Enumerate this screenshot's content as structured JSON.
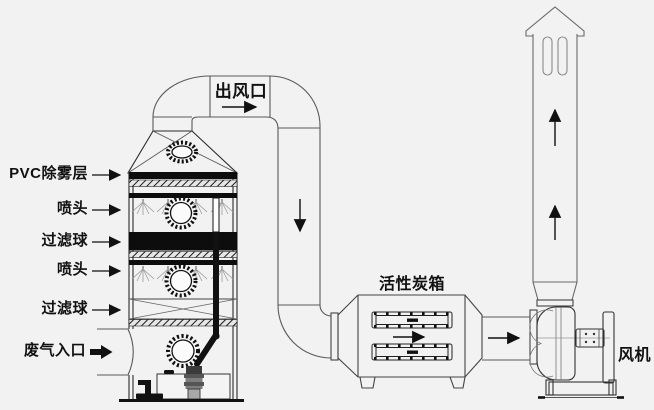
{
  "colors": {
    "background": "#f1f2f1",
    "main_line": "#2b2b2b",
    "duct_line": "#5a5a5a",
    "solid_band": "#0d0d0d",
    "spray_line": "#999999"
  },
  "labels": {
    "left_callouts": [
      {
        "text": "PVC除雾层"
      },
      {
        "text": "喷头"
      },
      {
        "text": "过滤球"
      },
      {
        "text": "喷头"
      },
      {
        "text": "过滤球"
      }
    ],
    "gas_inlet": "废气入口",
    "air_outlet": "出风口",
    "carbon_box": "活性炭箱",
    "fan": "风机"
  },
  "icons": {
    "waste-gas-inlet-arrow": "➡",
    "outlet-flow-arrow": "→",
    "downcomer-flow-arrow": "↓",
    "carbon-box-flow-arrow": "→",
    "fan-inlet-flow-arrow": "→",
    "stack-flow-arrow-upper": "↑",
    "stack-flow-arrow-lower": "↑",
    "callout-leader-arrows": "→"
  }
}
